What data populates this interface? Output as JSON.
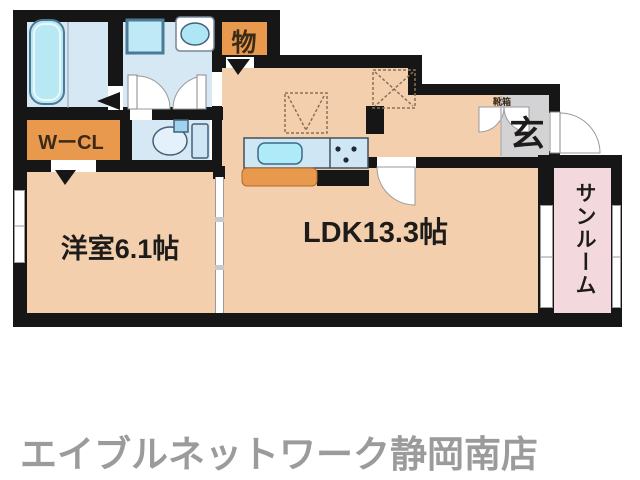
{
  "floorplan": {
    "rooms": {
      "western": {
        "label": "洋室6.1帖"
      },
      "ldk": {
        "label": "LDK13.3帖"
      },
      "entrance": {
        "label": "玄"
      },
      "storage": {
        "label": "物"
      },
      "wcl": {
        "label": "WーCL"
      },
      "shoebox": {
        "label": "靴箱"
      },
      "sunroom": {
        "label": "サンルーム"
      }
    },
    "colors": {
      "wall": "#161616",
      "room_floor_peach": "#f3cfae",
      "closet_orange": "#e9994d",
      "wet_area_blue": "#d6e8f3",
      "fixture_cyan": "#aee4f4",
      "entrance_gray": "#d3d3d5",
      "sunroom_pink": "#f3d9dd",
      "dashed_reserve": "#8a7258",
      "footer_text": "#9b9b9b"
    }
  },
  "footer": {
    "store_name": "エイブルネットワーク静岡南店"
  }
}
